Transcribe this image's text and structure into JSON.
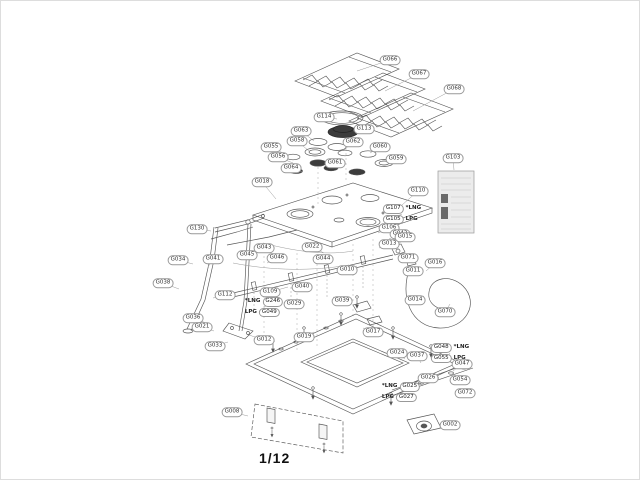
{
  "page": {
    "number": "1/12"
  },
  "colors": {
    "line": "#555555",
    "label_border": "#999999",
    "dark_fill": "#3c3c3c",
    "panel_fill": "#ececec"
  },
  "callouts": [
    {
      "label": "G066",
      "x": 389,
      "y": 59,
      "lx": 356,
      "ly": 70
    },
    {
      "label": "G067",
      "x": 418,
      "y": 73,
      "lx": 384,
      "ly": 90
    },
    {
      "label": "G068",
      "x": 453,
      "y": 88,
      "lx": 412,
      "ly": 110
    },
    {
      "label": "G114",
      "x": 323,
      "y": 116,
      "lx": 336,
      "ly": 118
    },
    {
      "label": "G113",
      "x": 363,
      "y": 128,
      "lx": 352,
      "ly": 130
    },
    {
      "label": "G063",
      "x": 300,
      "y": 130,
      "lx": 313,
      "ly": 140
    },
    {
      "label": "G058",
      "x": 296,
      "y": 140,
      "lx": 308,
      "ly": 150
    },
    {
      "label": "G055",
      "x": 270,
      "y": 146,
      "lx": 286,
      "ly": 154
    },
    {
      "label": "G056",
      "x": 277,
      "y": 156,
      "lx": 292,
      "ly": 162
    },
    {
      "label": "G064",
      "x": 290,
      "y": 167,
      "lx": 302,
      "ly": 171
    },
    {
      "label": "G062",
      "x": 352,
      "y": 141,
      "lx": 342,
      "ly": 150
    },
    {
      "label": "G061",
      "x": 334,
      "y": 162,
      "lx": 328,
      "ly": 166
    },
    {
      "label": "G060",
      "x": 379,
      "y": 146,
      "lx": 369,
      "ly": 152
    },
    {
      "label": "G059",
      "x": 395,
      "y": 158,
      "lx": 385,
      "ly": 161
    },
    {
      "label": "G103",
      "x": 452,
      "y": 157,
      "lx": 453,
      "ly": 169
    },
    {
      "label": "G018",
      "x": 261,
      "y": 181,
      "lx": 275,
      "ly": 198
    },
    {
      "label": "G110",
      "x": 417,
      "y": 190,
      "lx": 401,
      "ly": 204
    },
    {
      "label": "G106",
      "x": 388,
      "y": 227,
      "lx": 377,
      "ly": 232
    },
    {
      "label": "G042",
      "x": 399,
      "y": 233,
      "lx": 388,
      "ly": 238
    },
    {
      "label": "G013",
      "x": 388,
      "y": 243,
      "lx": 378,
      "ly": 247
    },
    {
      "label": "G130",
      "x": 196,
      "y": 228,
      "lx": 210,
      "ly": 230
    },
    {
      "label": "G043",
      "x": 263,
      "y": 247,
      "lx": 252,
      "ly": 252
    },
    {
      "label": "G045",
      "x": 246,
      "y": 254,
      "lx": 241,
      "ly": 259
    },
    {
      "label": "G046",
      "x": 276,
      "y": 257,
      "lx": 266,
      "ly": 262
    },
    {
      "label": "G022",
      "x": 311,
      "y": 246,
      "lx": 323,
      "ly": 252
    },
    {
      "label": "G044",
      "x": 322,
      "y": 258,
      "lx": 331,
      "ly": 262
    },
    {
      "label": "G034",
      "x": 177,
      "y": 259,
      "lx": 192,
      "ly": 263
    },
    {
      "label": "G041",
      "x": 212,
      "y": 258,
      "lx": 207,
      "ly": 266
    },
    {
      "label": "G038",
      "x": 162,
      "y": 282,
      "lx": 178,
      "ly": 288
    },
    {
      "label": "G112",
      "x": 224,
      "y": 294,
      "lx": 212,
      "ly": 297
    },
    {
      "label": "G109",
      "x": 269,
      "y": 291,
      "lx": 287,
      "ly": 286
    },
    {
      "label": "G029",
      "x": 293,
      "y": 303,
      "lx": 300,
      "ly": 299
    },
    {
      "label": "G040",
      "x": 301,
      "y": 286,
      "lx": 309,
      "ly": 282
    },
    {
      "label": "G039",
      "x": 341,
      "y": 300,
      "lx": 332,
      "ly": 296
    },
    {
      "label": "G010",
      "x": 346,
      "y": 269,
      "lx": 356,
      "ly": 265
    },
    {
      "label": "G036",
      "x": 192,
      "y": 317,
      "lx": 205,
      "ly": 322
    },
    {
      "label": "G021",
      "x": 201,
      "y": 326,
      "lx": 213,
      "ly": 330
    },
    {
      "label": "G033",
      "x": 214,
      "y": 345,
      "lx": 227,
      "ly": 341
    },
    {
      "label": "G012",
      "x": 263,
      "y": 339,
      "lx": 248,
      "ly": 334
    },
    {
      "label": "G019",
      "x": 303,
      "y": 336,
      "lx": 313,
      "ly": 331
    },
    {
      "label": "G017",
      "x": 372,
      "y": 331,
      "lx": 362,
      "ly": 327
    },
    {
      "label": "G015",
      "x": 404,
      "y": 236,
      "lx": 397,
      "ly": 244
    },
    {
      "label": "G071",
      "x": 407,
      "y": 257,
      "lx": 398,
      "ly": 259
    },
    {
      "label": "G011",
      "x": 412,
      "y": 270,
      "lx": 404,
      "ly": 268
    },
    {
      "label": "G016",
      "x": 434,
      "y": 262,
      "lx": 425,
      "ly": 270
    },
    {
      "label": "G014",
      "x": 414,
      "y": 299,
      "lx": 423,
      "ly": 295
    },
    {
      "label": "G070",
      "x": 444,
      "y": 311,
      "lx": 449,
      "ly": 303
    },
    {
      "label": "G024",
      "x": 396,
      "y": 352,
      "lx": 404,
      "ly": 358
    },
    {
      "label": "G037",
      "x": 416,
      "y": 355,
      "lx": 420,
      "ly": 362
    },
    {
      "label": "G047",
      "x": 461,
      "y": 363,
      "lx": 452,
      "ly": 370
    },
    {
      "label": "G026",
      "x": 427,
      "y": 377,
      "lx": 434,
      "ly": 381
    },
    {
      "label": "G054",
      "x": 459,
      "y": 379,
      "lx": 450,
      "ly": 383
    },
    {
      "label": "G072",
      "x": 464,
      "y": 392,
      "lx": 454,
      "ly": 392
    },
    {
      "label": "G002",
      "x": 449,
      "y": 424,
      "lx": 438,
      "ly": 427
    },
    {
      "label": "G008",
      "x": 231,
      "y": 411,
      "lx": 247,
      "ly": 415
    }
  ],
  "gas_notes": [
    {
      "x": 401,
      "y": 213,
      "lx": 383,
      "ly": 221,
      "rows": [
        {
          "code": "G107",
          "note": "*LNG",
          "noteFirst": false
        },
        {
          "code": "G105",
          "note": "LPG",
          "noteFirst": false
        }
      ]
    },
    {
      "x": 263,
      "y": 306,
      "lx": 278,
      "ly": 300,
      "rows": [
        {
          "code": "G246",
          "note": "*LNG",
          "noteFirst": true
        },
        {
          "code": "G049",
          "note": "LPG",
          "noteFirst": true
        }
      ]
    },
    {
      "x": 449,
      "y": 352,
      "lx": 443,
      "ly": 361,
      "rows": [
        {
          "code": "G048",
          "note": "*LNG",
          "noteFirst": false
        },
        {
          "code": "G055",
          "note": "LPG",
          "noteFirst": false
        }
      ]
    },
    {
      "x": 400,
      "y": 391,
      "lx": 409,
      "ly": 386,
      "rows": [
        {
          "code": "G025",
          "note": "*LNG",
          "noteFirst": true
        },
        {
          "code": "G027",
          "note": "LPG",
          "noteFirst": true
        }
      ]
    }
  ]
}
